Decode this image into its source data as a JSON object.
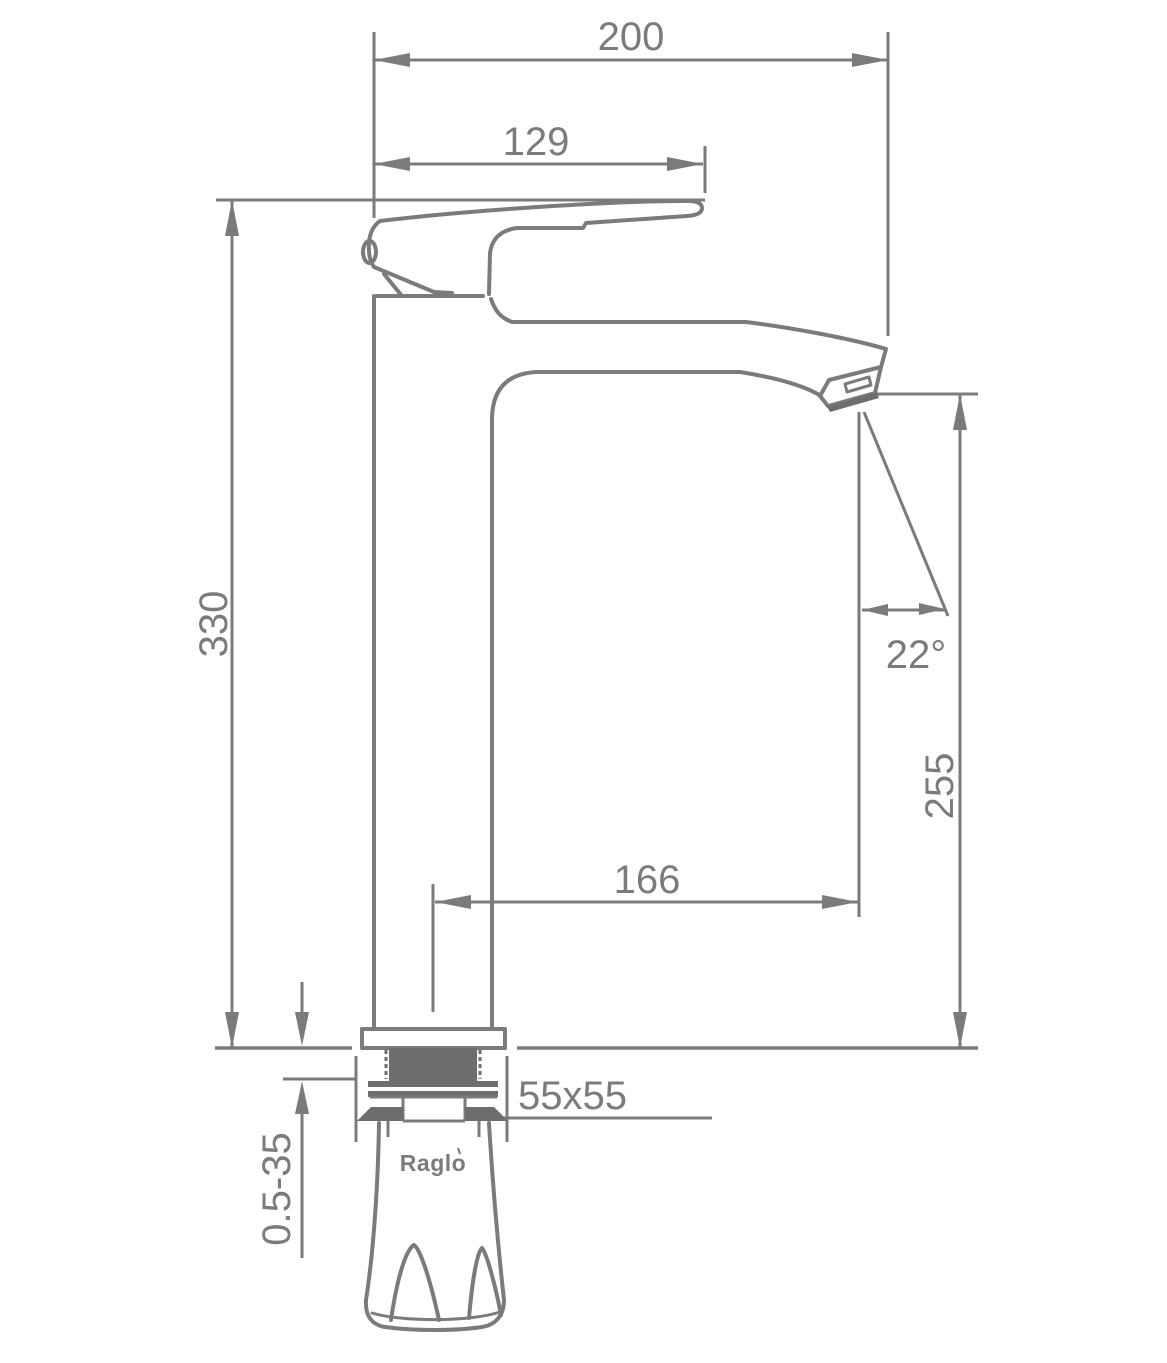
{
  "drawing": {
    "type": "faucet-installation-technical-drawing",
    "brand": "Raglo",
    "colors": {
      "line": "#7b7b7b",
      "dark_fill": "#6d6d6d",
      "background": "#ffffff"
    },
    "dimensions": {
      "total_reach": "200",
      "handle_length": "129",
      "body_height": "330",
      "spout_angle": "22°",
      "spout_height": "255",
      "spout_reach": "166",
      "base_size": "55x55",
      "mount_thickness_range": "0.5-35"
    }
  }
}
